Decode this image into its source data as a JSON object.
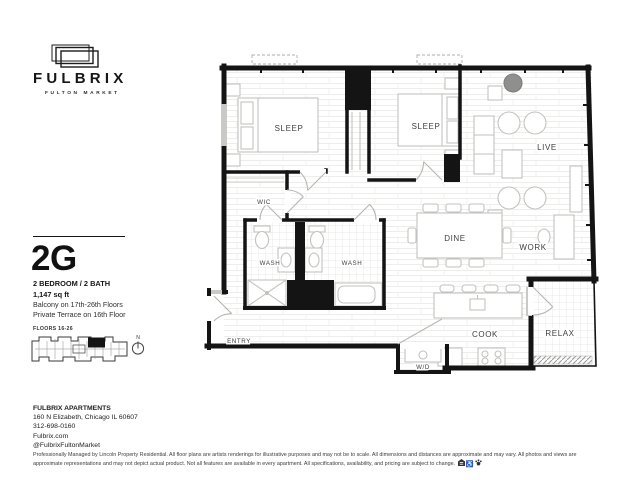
{
  "brand": {
    "name": "FULBRIX",
    "tagline": "FULTON MARKET"
  },
  "unit": {
    "code": "2G",
    "spec": "2 BEDROOM / 2 BATH",
    "area": "1,147 sq ft",
    "note_balcony": "Balcony on 17th-26th Floors",
    "note_terrace": "Private Terrace on 16th Floor",
    "floors_label": "FLOORS 16-26",
    "compass_label": "N"
  },
  "rooms": {
    "sleep1": "SLEEP",
    "sleep2": "SLEEP",
    "wic": "WIC",
    "live": "LIVE",
    "dine": "DINE",
    "work": "WORK",
    "wash1": "WASH",
    "wash2": "WASH",
    "entry": "ENTRY",
    "cook": "COOK",
    "wd": "W/D",
    "relax": "RELAX"
  },
  "contact": {
    "name": "FULBRIX APARTMENTS",
    "address": "160 N Elizabeth, Chicago IL 60607",
    "phone": "312-698-0160",
    "website": "Fulbrix.com",
    "social": "@FulbrixFultonMarket"
  },
  "legal": {
    "disclaimer": "Professionally Managed by Lincoln Property Residential. All floor plans are artists renderings for illustrative purposes and may not be to scale. All dimensions and distances are approximate and may vary. All photos and views are approximate representations and may not depict actual product. Not all features are available in every apartment. All specifications, availability, and pricing are subject to change."
  },
  "icons": {
    "equal_housing": "equal-housing-icon",
    "accessibility": "accessibility-icon",
    "pet": "pet-icon"
  },
  "colors": {
    "wall": "#141414",
    "floor_line": "#e9e8e5",
    "furniture": "#c2c2bf",
    "window": "#c9c9c6"
  }
}
